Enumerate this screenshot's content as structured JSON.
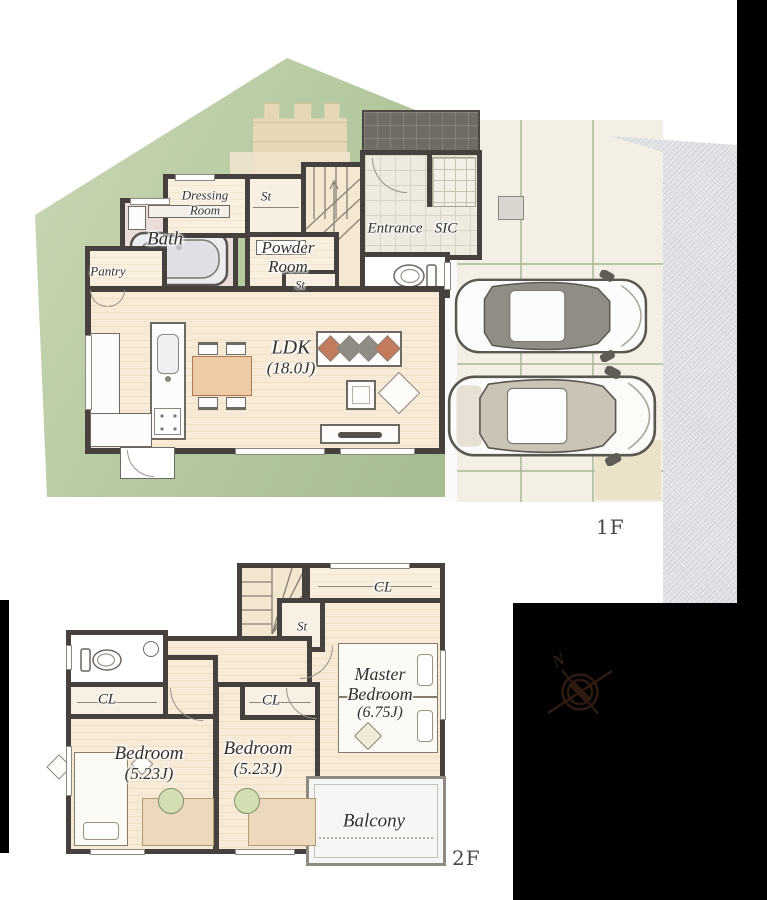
{
  "floor1": {
    "floor_label": "1F",
    "rooms": {
      "dressing_room": {
        "line1": "Dressing",
        "line2": "Room"
      },
      "st_upper": "St",
      "bath": "Bath",
      "powder_room": {
        "line1": "Powder",
        "line2": "Room"
      },
      "entrance": "Entrance",
      "sic": "SIC",
      "pantry": "Pantry",
      "st_lower": "St",
      "ldk": {
        "name": "LDK",
        "area": "(18.0J)"
      }
    }
  },
  "floor2": {
    "floor_label": "2F",
    "stairs_down_label": "DN",
    "rooms": {
      "cl_top": "CL",
      "st": "St",
      "master_bedroom": {
        "line1": "Master",
        "line2": "Bedroom",
        "area": "(6.75J)"
      },
      "cl_west": "CL",
      "cl_mid": "CL",
      "bedroom_west": {
        "name": "Bedroom",
        "area": "(5.23J)"
      },
      "bedroom_mid": {
        "name": "Bedroom",
        "area": "(5.23J)"
      },
      "balcony": "Balcony"
    },
    "compass_north": "N"
  },
  "colors": {
    "lawn_green": "#b7cba2",
    "wood_floor": "#f5e8d3",
    "wall_dark": "#46413c",
    "road_gray": "#dcdee1",
    "mask_black": "#000000",
    "bath_pink": "#ebdeda",
    "table_wood": "#eecaa5",
    "sofa_cushion_brown": "#c27b5c",
    "sofa_cushion_gray": "#8f8b85",
    "desk_chair_green": "#d3dfb2",
    "compass_brown": "#2e1b12"
  }
}
